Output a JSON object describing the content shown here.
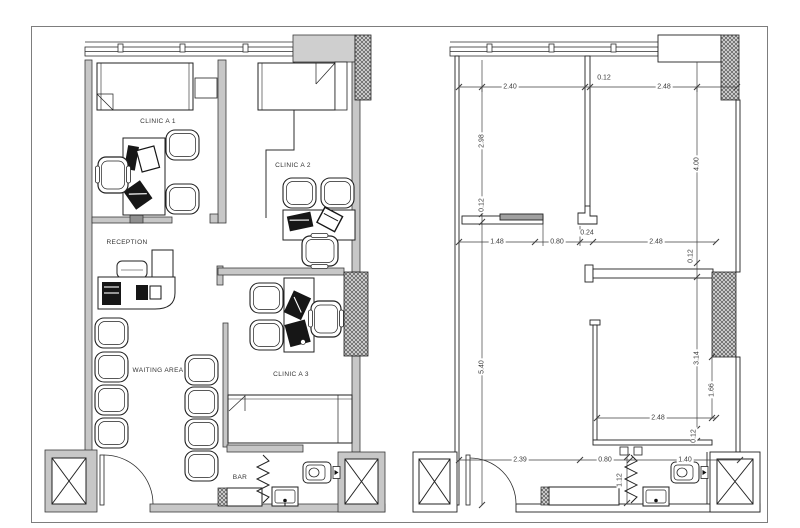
{
  "sheet": {
    "background": "#ffffff",
    "frame_color": "#7d7d7d"
  },
  "colors": {
    "wall_fill": "#c7c7c7",
    "line": "#2e2e2e",
    "dim_text": "#3b3b3b",
    "hatch": "#555555"
  },
  "plan_furnished": {
    "labels": {
      "clinic_a1": "CLINIC A 1",
      "clinic_a2": "CLINIC A 2",
      "reception": "RECEPTION",
      "waiting_area": "WAITING AREA",
      "clinic_a3": "CLINIC A 3",
      "bar": "BAR"
    }
  },
  "plan_dimensioned": {
    "dims": {
      "top_width_left": "2.40",
      "top_wall": "0.12",
      "top_width_right": "2.48",
      "left_upper": "2.98",
      "left_wall": "0.12",
      "left_lower": "5.40",
      "right_upper": "4.00",
      "right_wall_upper": "0.12",
      "right_mid": "3.14",
      "right_lower": "1.66",
      "right_wall_lower": "0.12",
      "mid_a": "1.48",
      "mid_b": "0.80",
      "mid_wall": "0.24",
      "mid_c": "2.48",
      "room_width": "2.48",
      "bottom_a": "2.39",
      "bottom_b": "0.80",
      "bottom_c": "1.40",
      "bath_depth": "1.12"
    }
  }
}
